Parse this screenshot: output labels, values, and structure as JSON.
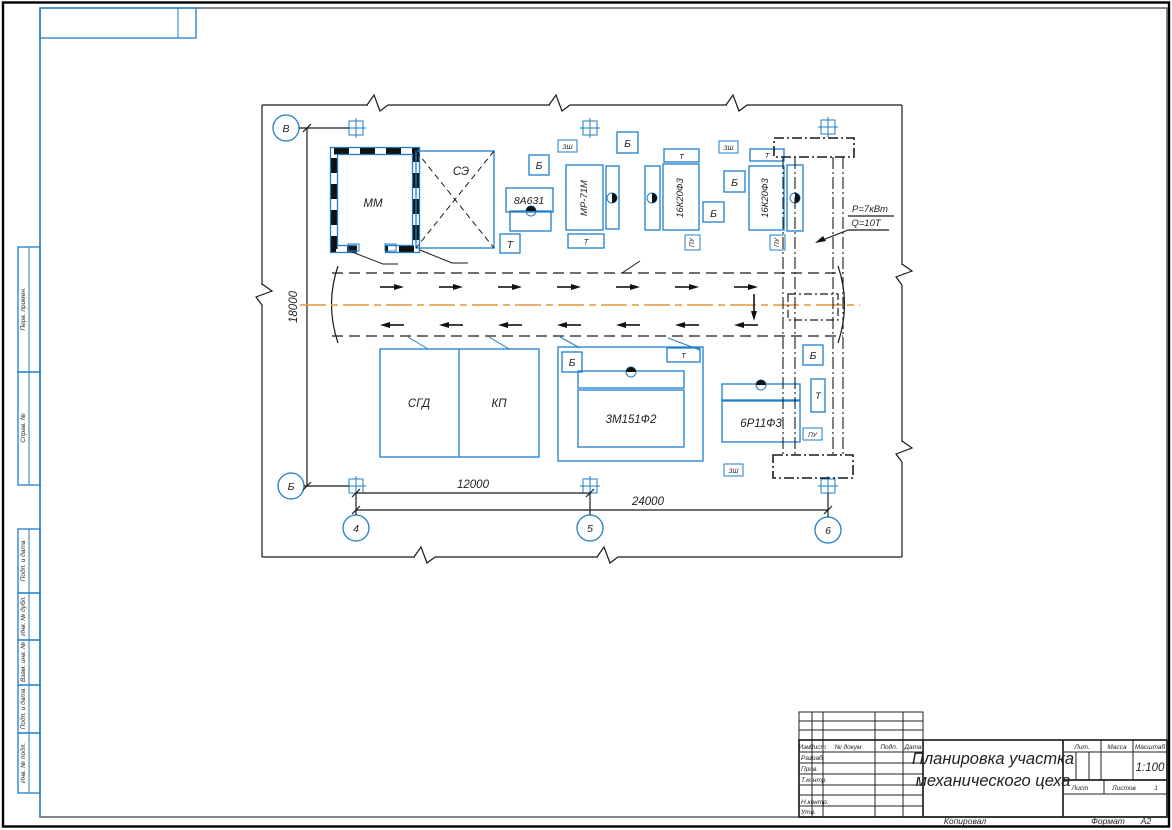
{
  "side_fields": [
    "Перв. примен.",
    "Справ. №",
    "Подп. и дата",
    "Инв. № дубл.",
    "Взам. инв. №",
    "Подп. и дата",
    "Инв. № подл."
  ],
  "plan": {
    "axes": {
      "top": "В",
      "bottom": "Б",
      "c1": "4",
      "c2": "5",
      "c3": "6"
    },
    "dims": {
      "height": "18000",
      "bay": "12000",
      "total": "24000"
    },
    "rooms": {
      "mm": "ММ",
      "se": "СЭ",
      "sgd": "СГД",
      "kp": "КП"
    },
    "machines": {
      "saw": "8А631",
      "centering": "МР-71М",
      "lathe": "16К20Ф3",
      "grinder": "3М151Ф2",
      "mill": "6Р11Ф3"
    },
    "tags": {
      "b": "Б",
      "t": "Т",
      "pu": "ПУ",
      "zsh": "ЗШ"
    },
    "crane": {
      "line1": "Р=7кВт",
      "line2": "Q=10Т"
    }
  },
  "title_block": {
    "cols": [
      "Изм.",
      "Лист",
      "№ докум.",
      "Подп.",
      "Дата"
    ],
    "rows": [
      "Разраб.",
      "Пров.",
      "Т.контр.",
      "Н.контр.",
      "Утв."
    ],
    "title1": "Планировка участка",
    "title2": "механического цеха",
    "lit": "Лит.",
    "mass": "Масса",
    "scale": "Масштаб",
    "scale_value": "1:100",
    "sheet": "Лист",
    "sheets": "Листов",
    "sheets_value": "1"
  },
  "footer": {
    "copied": "Копировал",
    "format": "Формат",
    "format_value": "А2"
  }
}
